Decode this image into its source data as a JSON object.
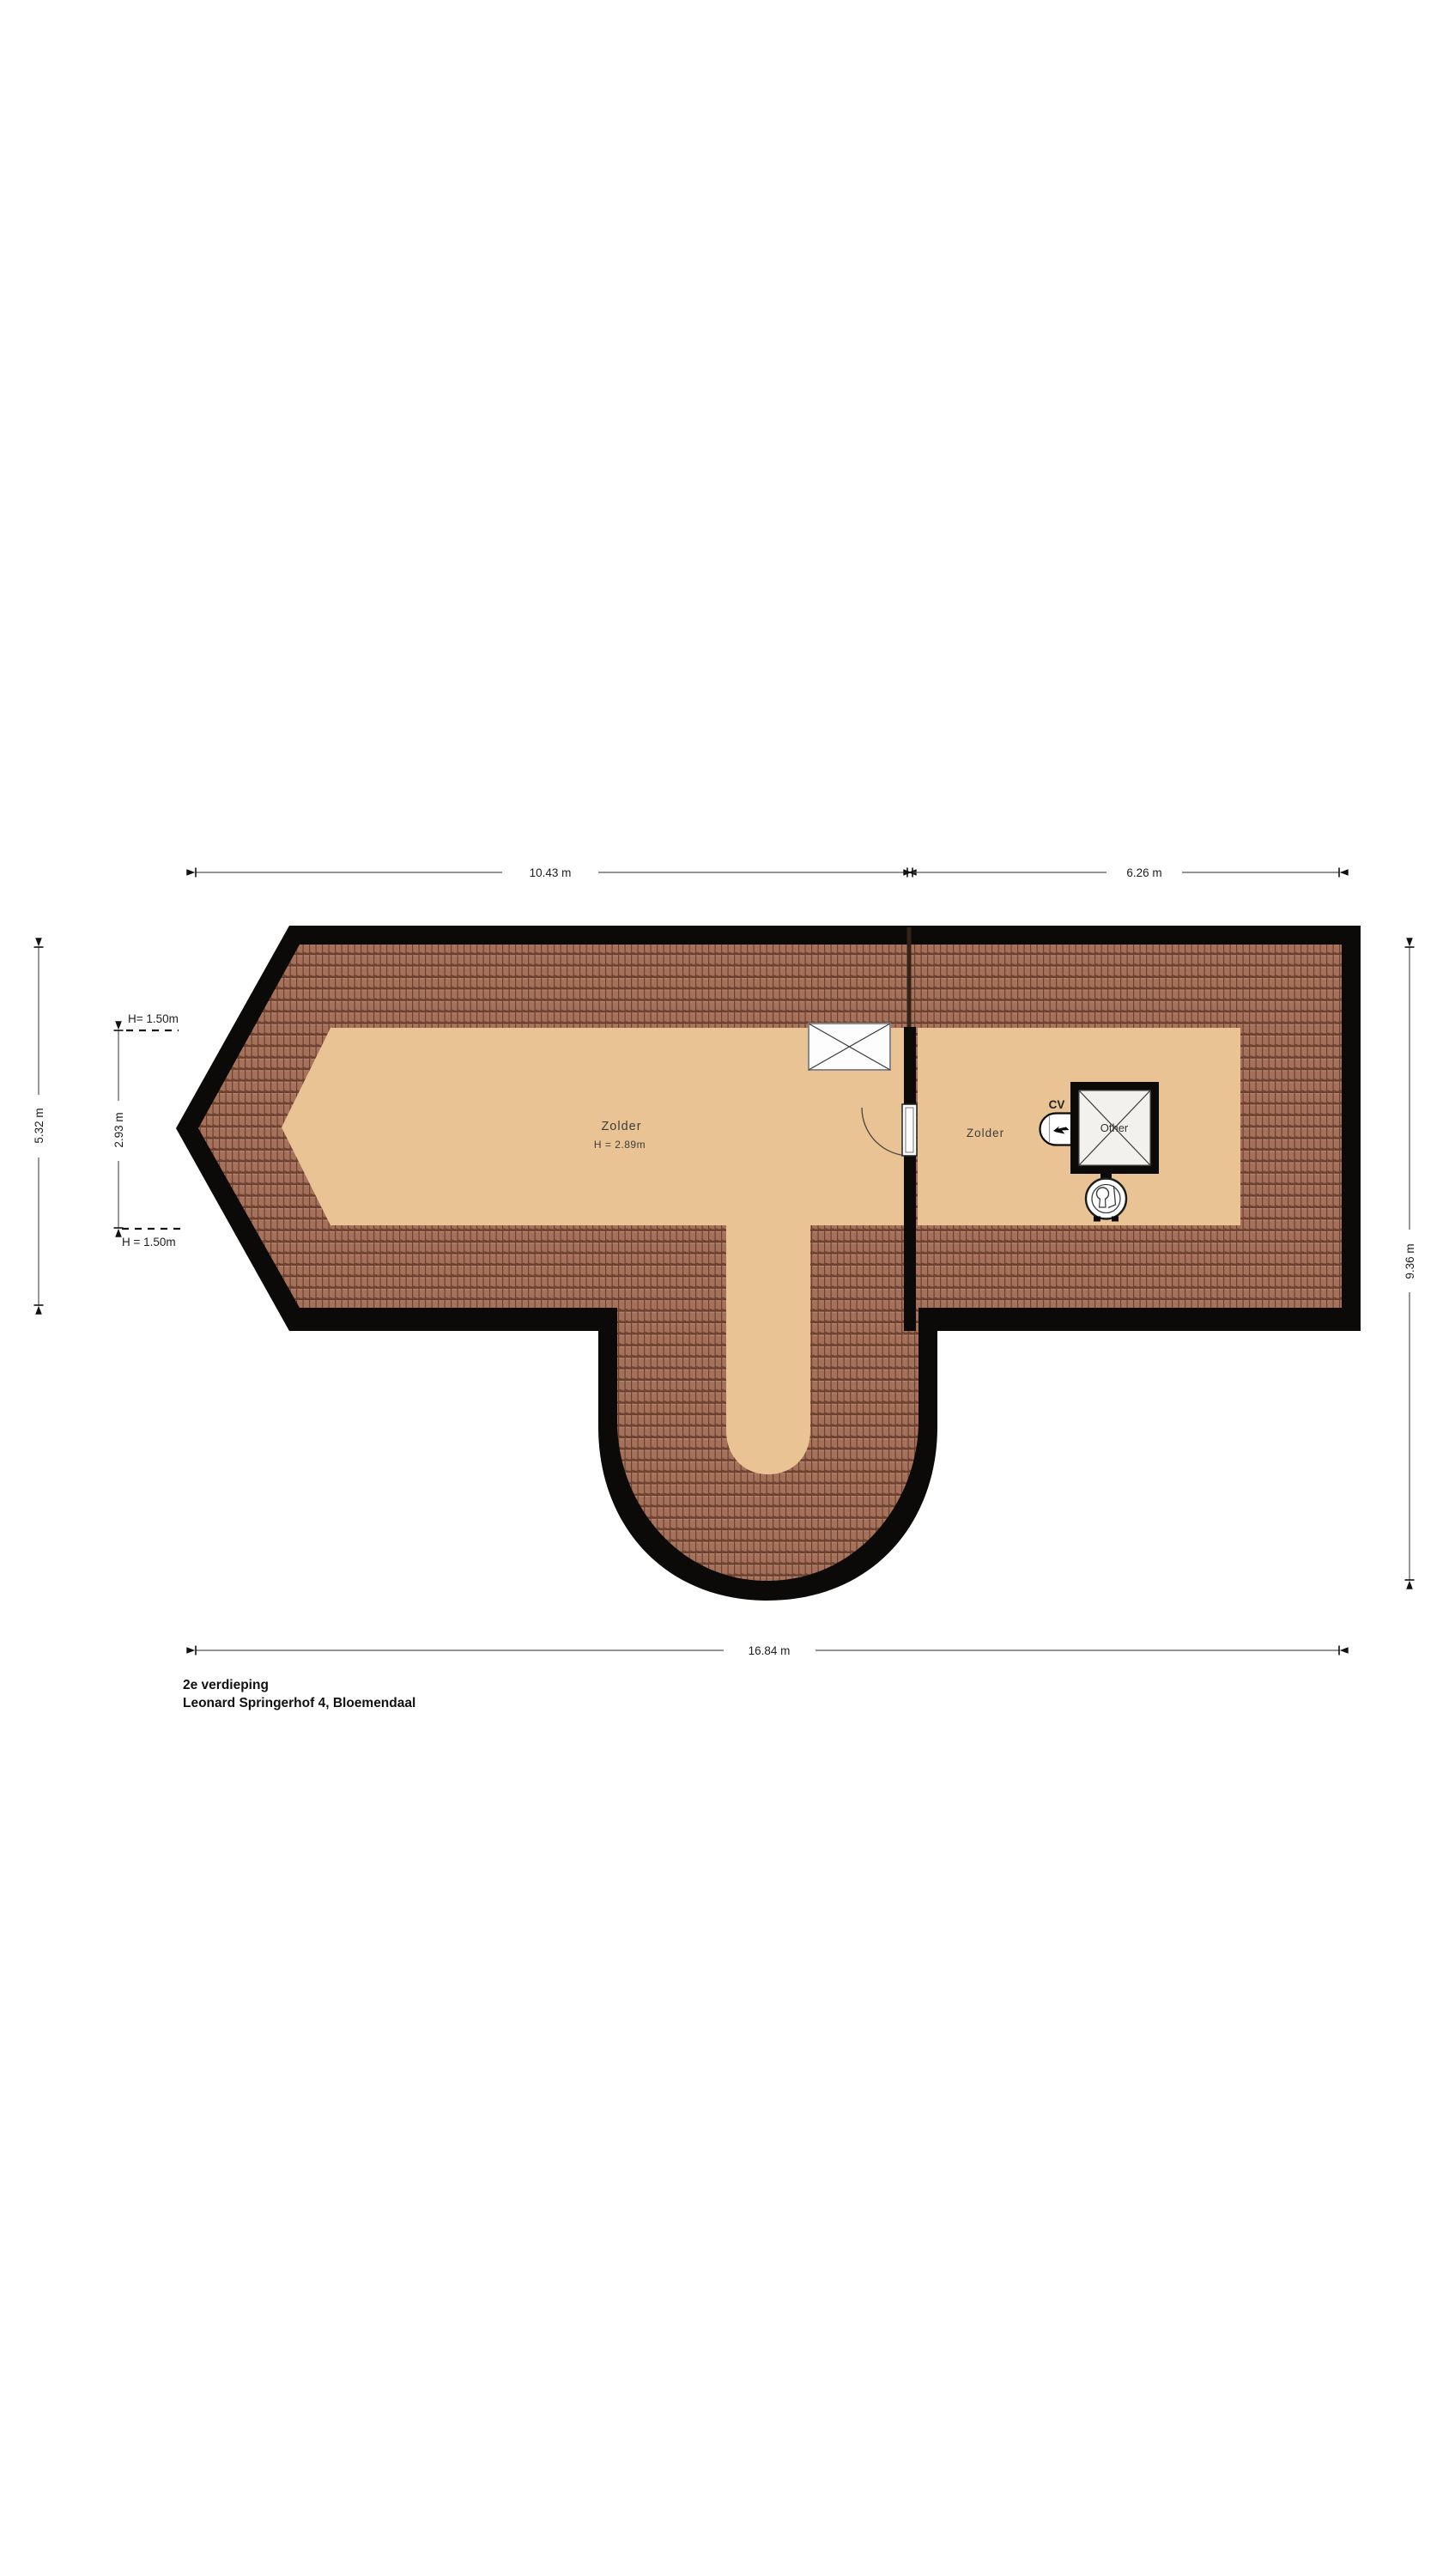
{
  "title": {
    "floor": "2e verdieping",
    "address": "Leonard Springerhof 4, Bloemendaal"
  },
  "dimensions": {
    "top_left": "10.43 m",
    "top_right": "6.26 m",
    "bottom": "16.84 m",
    "left_outer": "5.32 m",
    "left_inner": "2.93 m",
    "right": "9.36 m",
    "height_top": "H= 1.50m",
    "height_bottom": "H = 1.50m"
  },
  "rooms": {
    "zolder_left": {
      "name": "Zolder",
      "ceiling_height": "H = 2.89m"
    },
    "zolder_right": {
      "name": "Zolder"
    }
  },
  "fixtures": {
    "cv_label": "CV",
    "shaft_label": "Other"
  },
  "colors": {
    "wall": "#0c0a09",
    "roof_tile": "#a5715a",
    "roof_tile_line": "#6b4232",
    "floor": "#e9c394",
    "dimension_line": "#555555",
    "text": "#1d1d1d"
  }
}
